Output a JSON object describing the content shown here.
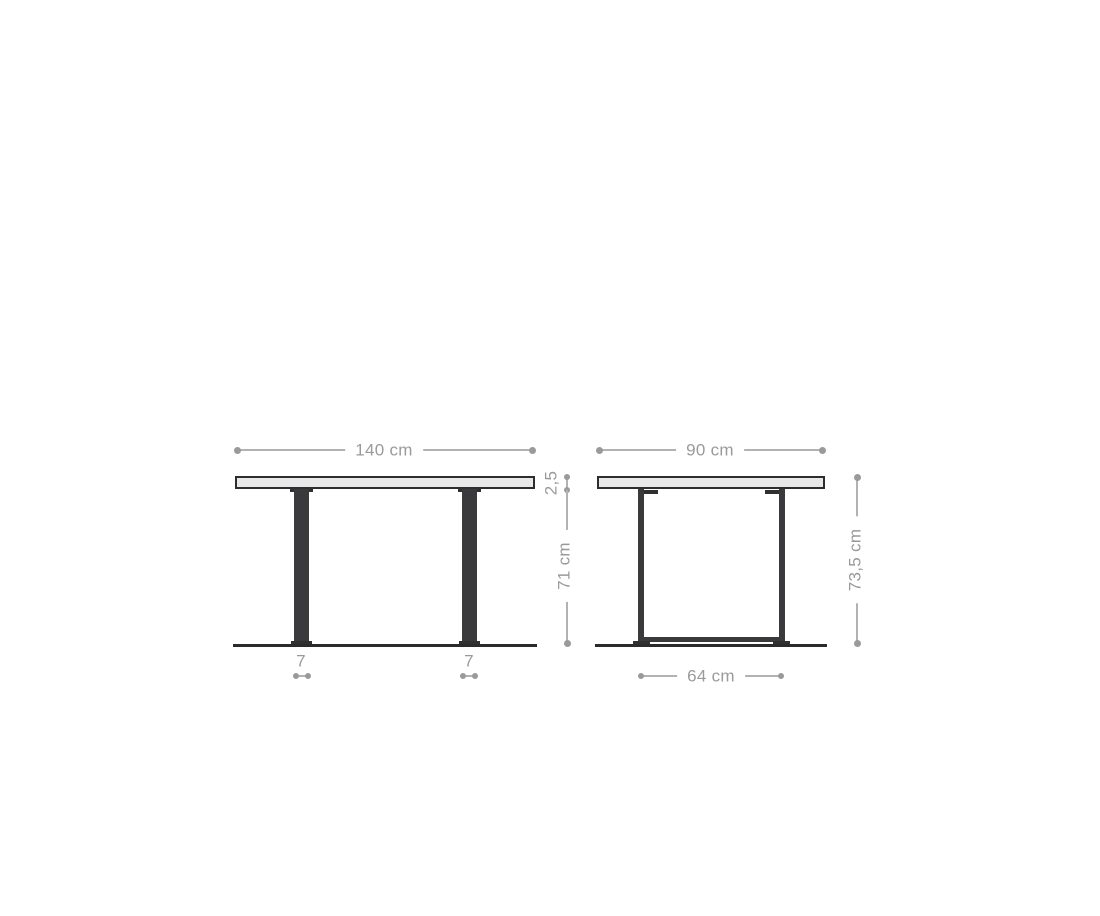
{
  "diagram": {
    "front_view": {
      "width": "140 cm",
      "top_thickness": "2,5",
      "leg_height": "71 cm",
      "leg_width_left": "7",
      "leg_width_right": "7"
    },
    "side_view": {
      "depth": "90 cm",
      "total_height": "73,5 cm",
      "base_depth": "64 cm"
    },
    "colors": {
      "dimension_gray": "#9a9a9a",
      "dimension_line": "#b2b2b2",
      "frame_dark": "#3a3a3c",
      "tabletop_fill": "#e8e8e8",
      "outline_dark": "#2d2d2d",
      "background": "#ffffff"
    }
  }
}
